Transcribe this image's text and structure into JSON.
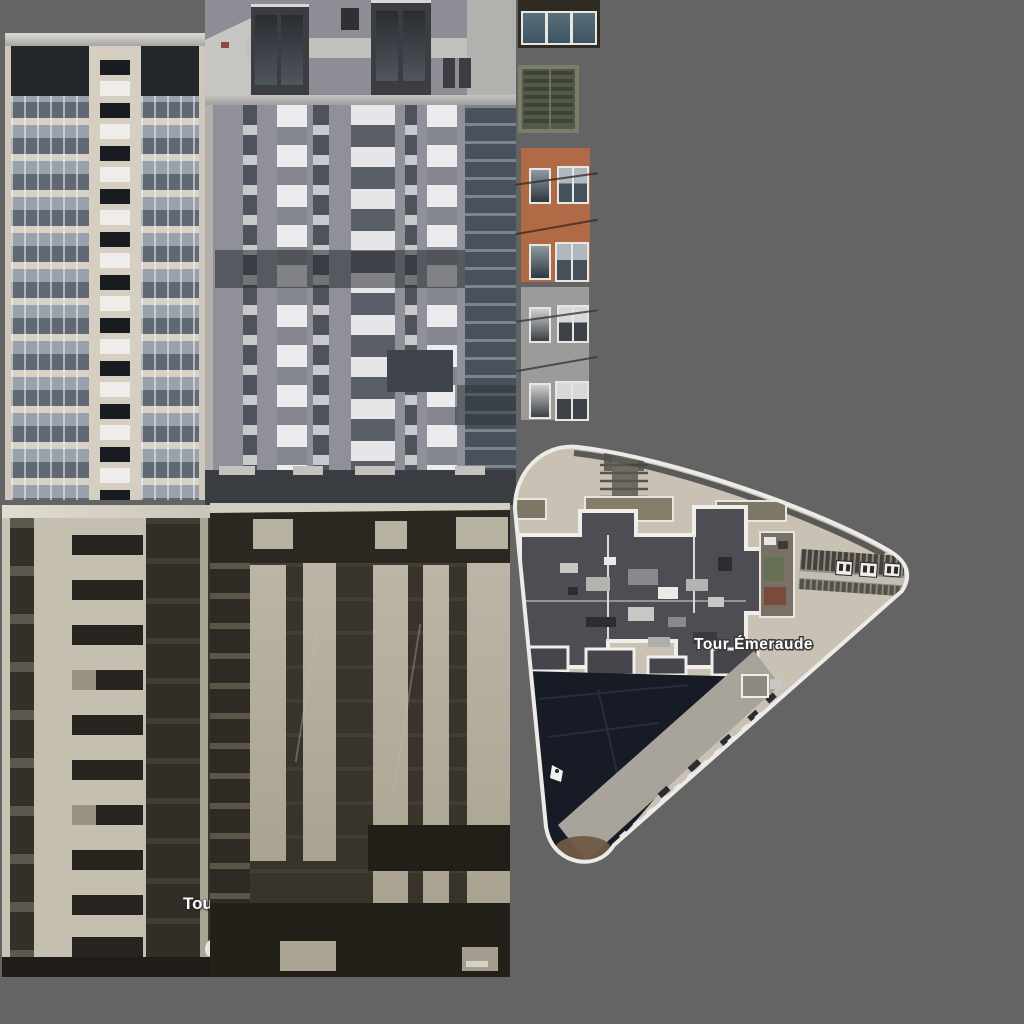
{
  "labels": {
    "aerial": "Tour Émeraude",
    "partial": "Tou"
  },
  "regions": [
    "facade-balcony-tower",
    "facade-gray-tower",
    "tile-balcony-glass",
    "tile-window-green",
    "tile-facade-brick",
    "tile-facade-gray",
    "aerial-view-tour-emeraude",
    "facade-dark-left",
    "facade-dark-mid"
  ],
  "colors": {
    "background": "#646464",
    "beige_facade": "#d5cec1",
    "balcony_glass": "#99a2ac",
    "gray_facade": "#8d8d95",
    "white_panel": "#ececee",
    "brick": "#b06a46",
    "gray_tile": "#9b9b99",
    "glass_blue": "#4a6574",
    "green_window": "#55594a",
    "sepia_wall": "#c5bfb0",
    "sepia_dark": "#33302a",
    "aerial_ground": "#c8c1b4",
    "roof_dark": "#4e4d53",
    "shadow_navy": "#161b25",
    "label_white": "#ffffff"
  }
}
